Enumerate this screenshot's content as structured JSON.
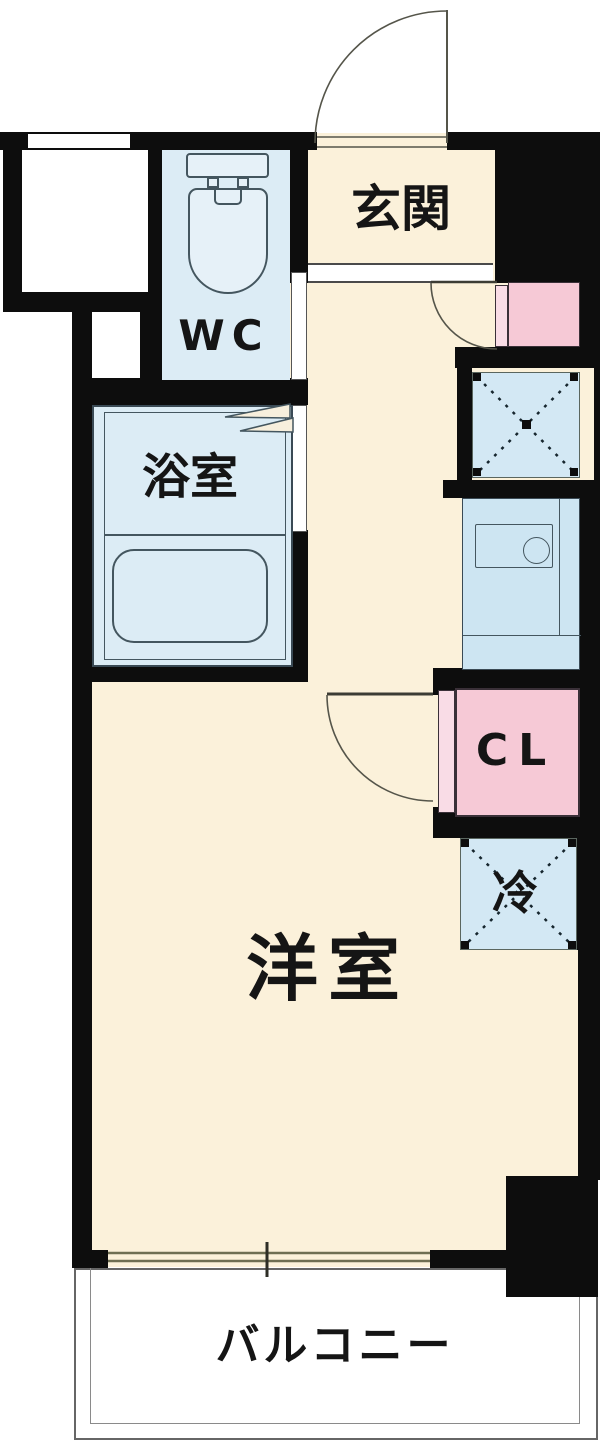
{
  "floorplan": {
    "title": "1R apartment floor plan",
    "rooms": {
      "entrance": {
        "label": "玄関"
      },
      "toilet": {
        "label": "WC"
      },
      "bathroom": {
        "label": "浴室"
      },
      "main_room": {
        "label": "洋室"
      },
      "closet": {
        "label": "CL"
      },
      "refrigerator_space": {
        "label": "冷"
      },
      "balcony": {
        "label": "バルコニー"
      }
    },
    "colors": {
      "wall": "#0d0d0d",
      "floor_cream": "#fbf1da",
      "wet_area_blue": "#dcecf5",
      "fixture_blue": "#d3e8f4",
      "kitchen_blue": "#cde5f2",
      "closet_pink": "#f6c9d6",
      "closet_door_pink": "#f9dce6",
      "fixture_border": "#44565f",
      "door_line": "#55554a",
      "window_line": "#6e6e52",
      "balcony_border": "#666666"
    }
  }
}
